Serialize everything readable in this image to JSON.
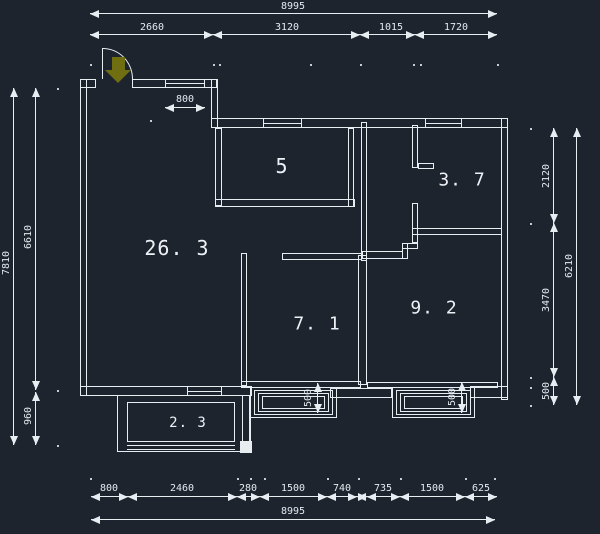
{
  "canvas": {
    "width": 600,
    "height": 534,
    "background": "#1d242e",
    "line_color": "#e8edf2",
    "text_color": "#e4e9ef",
    "entry_arrow_color": "#6f6f12"
  },
  "rooms": [
    {
      "n": "room-label-5",
      "label": "5",
      "x": 282,
      "y": 166,
      "size": 20
    },
    {
      "n": "room-label-3-7",
      "label": "3. 7",
      "x": 462,
      "y": 180,
      "size": 18
    },
    {
      "n": "room-label-26-3",
      "label": "26. 3",
      "x": 177,
      "y": 248,
      "size": 20
    },
    {
      "n": "room-label-7-1",
      "label": "7. 1",
      "x": 317,
      "y": 324,
      "size": 18
    },
    {
      "n": "room-label-9-2",
      "label": "9. 2",
      "x": 434,
      "y": 308,
      "size": 18
    },
    {
      "n": "room-label-2-3",
      "label": "2. 3",
      "x": 188,
      "y": 423,
      "size": 14
    }
  ],
  "walls": [
    {
      "n": "left-wall",
      "x": 80,
      "y": 79,
      "w": 7,
      "h": 317
    },
    {
      "n": "top-wall-left-a",
      "x": 80,
      "y": 79,
      "w": 16,
      "h": 9
    },
    {
      "n": "top-wall-left-b",
      "x": 132,
      "y": 79,
      "w": 85,
      "h": 9
    },
    {
      "n": "top-step-wall",
      "x": 211,
      "y": 79,
      "w": 7,
      "h": 49
    },
    {
      "n": "top-wall-right",
      "x": 211,
      "y": 118,
      "w": 297,
      "h": 10
    },
    {
      "n": "right-wall",
      "x": 501,
      "y": 118,
      "w": 7,
      "h": 282
    },
    {
      "n": "bottom-wall-left",
      "x": 80,
      "y": 386,
      "w": 172,
      "h": 10
    },
    {
      "n": "bottom-wall-mid",
      "x": 330,
      "y": 388,
      "w": 62,
      "h": 10
    },
    {
      "n": "bottom-wall-right",
      "x": 470,
      "y": 386,
      "w": 38,
      "h": 12
    },
    {
      "n": "room5-left-wall",
      "x": 215,
      "y": 128,
      "w": 7,
      "h": 78
    },
    {
      "n": "room5-bottom-wall",
      "x": 215,
      "y": 199,
      "w": 140,
      "h": 8
    },
    {
      "n": "room5-right-wall",
      "x": 348,
      "y": 128,
      "w": 6,
      "h": 79
    },
    {
      "n": "shaft-left-wall",
      "x": 361,
      "y": 122,
      "w": 6,
      "h": 139
    },
    {
      "n": "room37-left-wall-upper",
      "x": 412,
      "y": 125,
      "w": 6,
      "h": 43
    },
    {
      "n": "room37-left-wall-lower",
      "x": 412,
      "y": 203,
      "w": 6,
      "h": 40
    },
    {
      "n": "room37-bottom-wall",
      "x": 412,
      "y": 228,
      "w": 90,
      "h": 7
    },
    {
      "n": "room37-door-stub",
      "x": 418,
      "y": 163,
      "w": 16,
      "h": 6
    },
    {
      "n": "room92-top-wall",
      "x": 362,
      "y": 251,
      "w": 41,
      "h": 8
    },
    {
      "n": "room92-jog-wall-v",
      "x": 402,
      "y": 243,
      "w": 6,
      "h": 16
    },
    {
      "n": "room92-jog-wall-h",
      "x": 402,
      "y": 243,
      "w": 16,
      "h": 6
    },
    {
      "n": "room71-top-wall",
      "x": 282,
      "y": 253,
      "w": 80,
      "h": 7
    },
    {
      "n": "room71-left-wall",
      "x": 241,
      "y": 253,
      "w": 6,
      "h": 133
    },
    {
      "n": "room71-bottom-wall",
      "x": 241,
      "y": 381,
      "w": 120,
      "h": 7
    },
    {
      "n": "room92-bottom-wall",
      "x": 367,
      "y": 382,
      "w": 131,
      "h": 6
    },
    {
      "n": "partition-71-92",
      "x": 358,
      "y": 255,
      "w": 9,
      "h": 130
    },
    {
      "n": "balcony-side-wall",
      "x": 242,
      "y": 395,
      "w": 9,
      "h": 49
    }
  ],
  "filled_blocks": [
    {
      "n": "column-block",
      "x": 240,
      "y": 441,
      "w": 12,
      "h": 12
    }
  ],
  "balcony": {
    "outer": {
      "x": 117,
      "y": 395,
      "w": 133,
      "h": 57
    },
    "inner": {
      "x": 127,
      "y": 402,
      "w": 108,
      "h": 40
    },
    "glazing_lines": [
      [
        127,
        445,
        108
      ],
      [
        127,
        449,
        108
      ]
    ]
  },
  "bay_windows": [
    {
      "n": "bay-window-7-1",
      "rects": [
        [
          250,
          387,
          87,
          31
        ],
        [
          254,
          390,
          79,
          25
        ],
        [
          258,
          393,
          71,
          19
        ],
        [
          262,
          396,
          63,
          13
        ]
      ]
    },
    {
      "n": "bay-window-9-2",
      "rects": [
        [
          392,
          387,
          83,
          31
        ],
        [
          396,
          390,
          75,
          25
        ],
        [
          400,
          393,
          67,
          19
        ],
        [
          404,
          396,
          59,
          13
        ]
      ]
    }
  ],
  "windows": [
    {
      "n": "window-top-left",
      "x": 165,
      "y": 79,
      "w": 40,
      "h": 9
    },
    {
      "n": "window-room5",
      "x": 263,
      "y": 118,
      "w": 39,
      "h": 10
    },
    {
      "n": "window-room37",
      "x": 425,
      "y": 118,
      "w": 37,
      "h": 10
    },
    {
      "n": "window-bottom-left",
      "x": 187,
      "y": 386,
      "w": 35,
      "h": 10
    }
  ],
  "door": {
    "leaf": {
      "x": 102,
      "y": 48,
      "w": 1,
      "h": 31
    },
    "arc": {
      "x": 103,
      "y": 48,
      "w": 30,
      "h": 31
    },
    "arrow_shaft": {
      "x": 112,
      "y": 57,
      "w": 13,
      "h": 13
    },
    "arrow_head": {
      "x": 105,
      "y": 70,
      "w": 26,
      "h": 13
    }
  },
  "dimensions": [
    {
      "n": "dim-top-overall",
      "o": "h",
      "x1": 90,
      "x2": 497,
      "y": 13,
      "ticks": [],
      "labels": [
        {
          "t": "8995",
          "x": 293,
          "y": 7
        }
      ]
    },
    {
      "n": "dim-top-chain",
      "o": "h",
      "x1": 90,
      "x2": 497,
      "y": 34,
      "ticks": [
        213,
        360,
        415
      ],
      "labels": [
        {
          "t": "2660",
          "x": 152,
          "y": 28
        },
        {
          "t": "3120",
          "x": 287,
          "y": 28
        },
        {
          "t": "1015",
          "x": 391,
          "y": 28
        },
        {
          "t": "1720",
          "x": 456,
          "y": 28
        }
      ]
    },
    {
      "n": "dim-window-800",
      "o": "h",
      "x1": 165,
      "x2": 205,
      "y": 107,
      "ticks": [],
      "labels": [
        {
          "t": "800",
          "x": 185,
          "y": 100
        }
      ]
    },
    {
      "n": "dim-bottom-chain",
      "o": "h",
      "x1": 91,
      "x2": 497,
      "y": 496,
      "ticks": [
        128,
        237,
        260,
        327,
        357,
        367,
        400,
        465
      ],
      "labels": [
        {
          "t": "800",
          "x": 109,
          "y": 489
        },
        {
          "t": "2460",
          "x": 182,
          "y": 489
        },
        {
          "t": "280",
          "x": 248,
          "y": 489
        },
        {
          "t": "1500",
          "x": 293,
          "y": 489
        },
        {
          "t": "740",
          "x": 342,
          "y": 489
        },
        {
          "t": "735",
          "x": 383,
          "y": 489
        },
        {
          "t": "1500",
          "x": 432,
          "y": 489
        },
        {
          "t": "625",
          "x": 481,
          "y": 489
        }
      ]
    },
    {
      "n": "dim-bottom-overall",
      "o": "h",
      "x1": 91,
      "x2": 495,
      "y": 519,
      "ticks": [],
      "labels": [
        {
          "t": "8995",
          "x": 293,
          "y": 512
        }
      ]
    },
    {
      "n": "dim-left-overall",
      "o": "v",
      "x": 13,
      "y1": 88,
      "y2": 445,
      "ticks": [],
      "labels": [
        {
          "t": "7810",
          "x": 7,
          "y": 263,
          "rot": true
        }
      ]
    },
    {
      "n": "dim-left-6610",
      "o": "v",
      "x": 35,
      "y1": 88,
      "y2": 390,
      "ticks": [],
      "labels": [
        {
          "t": "6610",
          "x": 29,
          "y": 237,
          "rot": true
        }
      ]
    },
    {
      "n": "dim-left-960",
      "o": "v",
      "x": 35,
      "y1": 392,
      "y2": 445,
      "ticks": [],
      "labels": [
        {
          "t": "960",
          "x": 29,
          "y": 416,
          "rot": true
        }
      ]
    },
    {
      "n": "dim-right-2120",
      "o": "v",
      "x": 553,
      "y1": 128,
      "y2": 223,
      "ticks": [],
      "labels": [
        {
          "t": "2120",
          "x": 547,
          "y": 176,
          "rot": true
        }
      ]
    },
    {
      "n": "dim-right-3470",
      "o": "v",
      "x": 553,
      "y1": 223,
      "y2": 377,
      "ticks": [],
      "labels": [
        {
          "t": "3470",
          "x": 547,
          "y": 300,
          "rot": true
        }
      ]
    },
    {
      "n": "dim-right-500",
      "o": "v",
      "x": 553,
      "y1": 377,
      "y2": 405,
      "ticks": [],
      "labels": [
        {
          "t": "500",
          "x": 547,
          "y": 391,
          "rot": true
        }
      ]
    },
    {
      "n": "dim-right-overall",
      "o": "v",
      "x": 576,
      "y1": 128,
      "y2": 405,
      "ticks": [],
      "labels": [
        {
          "t": "6210",
          "x": 570,
          "y": 266,
          "rot": true
        }
      ]
    },
    {
      "n": "dim-bay71-500",
      "o": "v",
      "x": 317,
      "y1": 383,
      "y2": 413,
      "ticks": [],
      "labels": [
        {
          "t": "500",
          "x": 309,
          "y": 398,
          "rot": true
        }
      ]
    },
    {
      "n": "dim-bay92-500",
      "o": "v",
      "x": 461,
      "y1": 382,
      "y2": 413,
      "ticks": [],
      "labels": [
        {
          "t": "500",
          "x": 453,
          "y": 397,
          "rot": true
        }
      ]
    }
  ],
  "dots": [
    [
      90,
      64
    ],
    [
      213,
      64
    ],
    [
      219,
      64
    ],
    [
      360,
      64
    ],
    [
      413,
      64
    ],
    [
      420,
      64
    ],
    [
      497,
      64
    ],
    [
      90,
      478
    ],
    [
      237,
      478
    ],
    [
      250,
      478
    ],
    [
      264,
      478
    ],
    [
      327,
      478
    ],
    [
      358,
      478
    ],
    [
      400,
      478
    ],
    [
      465,
      478
    ],
    [
      494,
      478
    ],
    [
      57,
      88
    ],
    [
      57,
      390
    ],
    [
      57,
      445
    ],
    [
      530,
      128
    ],
    [
      530,
      223
    ],
    [
      530,
      377
    ],
    [
      530,
      387
    ],
    [
      530,
      405
    ],
    [
      150,
      120
    ],
    [
      310,
      64
    ]
  ]
}
